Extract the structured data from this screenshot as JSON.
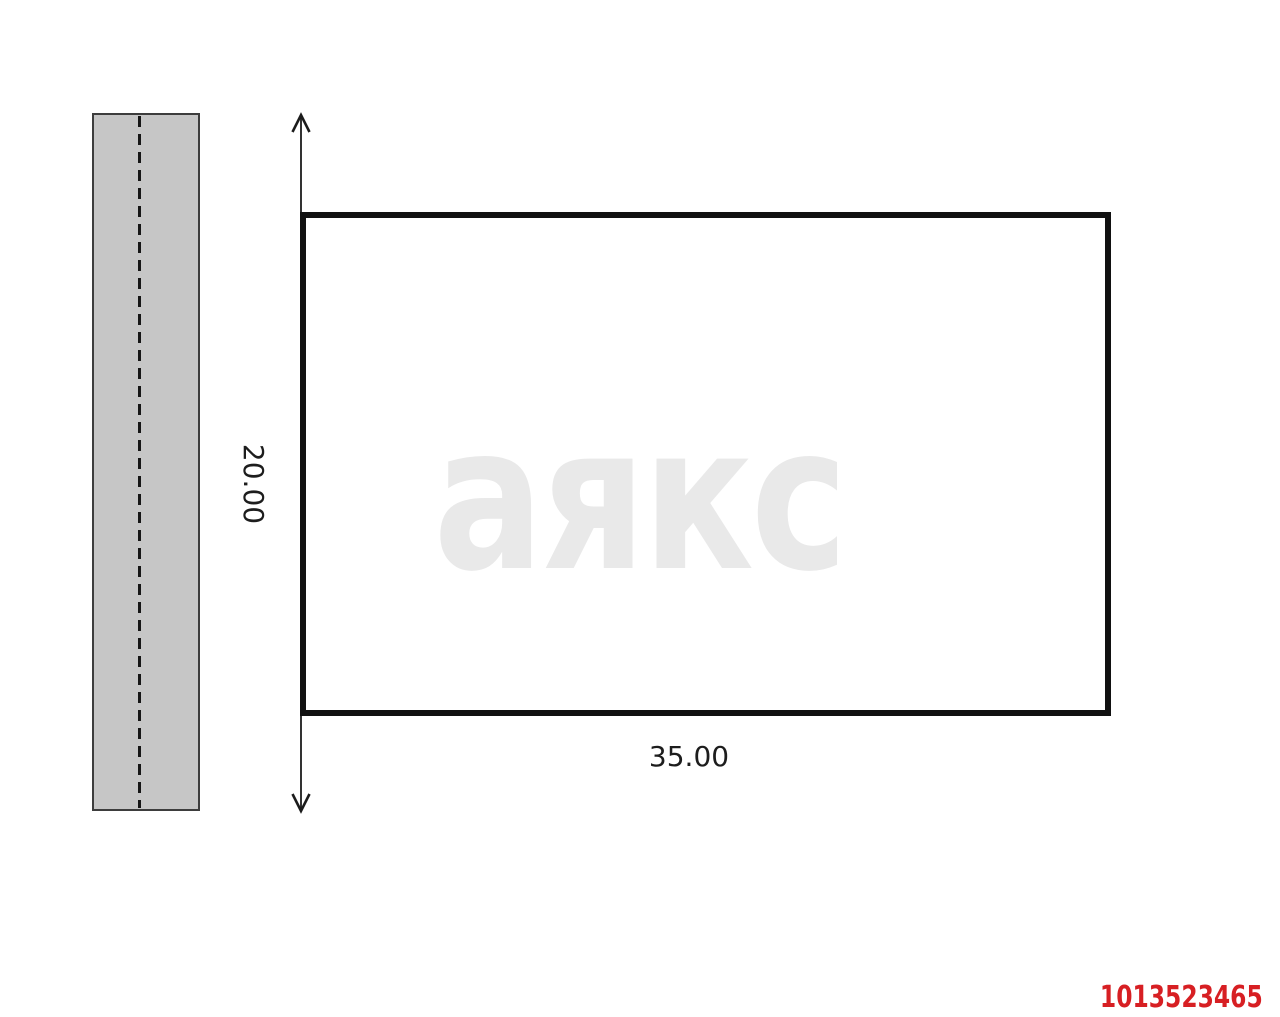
{
  "scheme": {
    "title": "land-plot-scheme",
    "plot": {
      "width_label": "35.00",
      "depth_label": "20.00",
      "width_m": 35.0,
      "depth_m": 20.0,
      "border_color": "#111111",
      "fill": "none"
    },
    "road": {
      "fill": "#c6c6c6",
      "stroke": "#3d3d3d",
      "centerline_color": "#161616"
    },
    "dimension": {
      "line_color": "#1c1c1c"
    },
    "watermark": {
      "text": "аякс",
      "color": "#e9e9e9"
    },
    "listing_id": {
      "value": "1013523465",
      "color": "#d71f23"
    }
  }
}
